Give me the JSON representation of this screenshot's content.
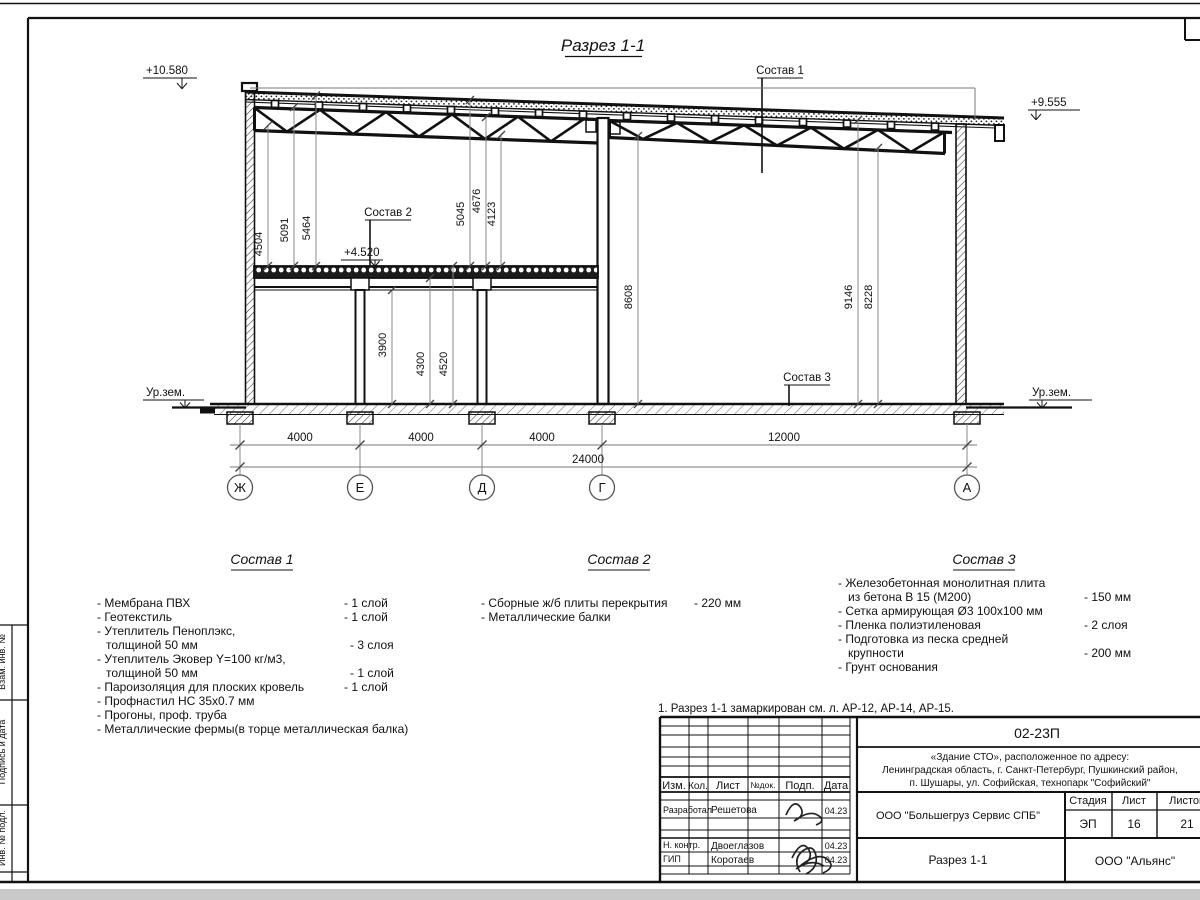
{
  "title": "Разрез 1-1",
  "note": "1. Разрез 1-1 замаркирован см. л. АР-12, АР-14, АР-15.",
  "elevations": {
    "roof_left": "+10.580",
    "roof_right": "+9.555",
    "mezzanine": "+4.520",
    "ground_left": "Ур.зем.",
    "ground_right": "Ур.зем."
  },
  "callouts": {
    "c1": "Состав 1",
    "c2": "Состав 2",
    "c3": "Состав 3"
  },
  "axes": [
    "Ж",
    "Е",
    "Д",
    "Г",
    "А"
  ],
  "dims": {
    "bottom": [
      "4000",
      "4000",
      "4000",
      "12000"
    ],
    "total": "24000",
    "left_stack": [
      "4504",
      "5091",
      "5464"
    ],
    "mid_stack": [
      "5045",
      "4676",
      "4123"
    ],
    "right_stack": [
      "8608",
      "9146",
      "8228"
    ],
    "mezz_stack": [
      "3900",
      "4300",
      "4520"
    ]
  },
  "sostav1": {
    "title": "Состав 1",
    "rows": [
      {
        "t": "- Мембрана ПВХ",
        "v": "- 1 слой"
      },
      {
        "t": "- Геотекстиль",
        "v": "- 1 слой"
      },
      {
        "t": "- Утеплитель Пеноплэкс,",
        "v": ""
      },
      {
        "t": "толщиной 50 мм",
        "v": "- 3 слоя"
      },
      {
        "t": "- Утеплитель Эковер Y=100 кг/м3,",
        "v": ""
      },
      {
        "t": "толщиной 50 мм",
        "v": "- 1 слой"
      },
      {
        "t": "- Пароизоляция для плоских кровель",
        "v": "- 1 слой"
      },
      {
        "t": "- Профнастил НС 35х0.7 мм",
        "v": ""
      },
      {
        "t": "- Прогоны, проф. труба",
        "v": ""
      },
      {
        "t": "- Металлические фермы(в торце металлическая балка)",
        "v": ""
      }
    ]
  },
  "sostav2": {
    "title": "Состав 2",
    "rows": [
      {
        "t": "- Сборные ж/б плиты перекрытия",
        "v": "- 220 мм"
      },
      {
        "t": "- Металлические балки",
        "v": ""
      }
    ]
  },
  "sostav3": {
    "title": "Состав 3",
    "rows": [
      {
        "t": "- Железобетонная  монолитная плита",
        "v": ""
      },
      {
        "t": "из бетона В 15 (М200)",
        "v": "- 150 мм"
      },
      {
        "t": "- Сетка армирующая Ø3 100х100 мм",
        "v": ""
      },
      {
        "t": "- Пленка полиэтиленовая",
        "v": "-  2 слоя"
      },
      {
        "t": "- Подготовка из песка средней",
        "v": ""
      },
      {
        "t": "крупности",
        "v": "- 200 мм"
      },
      {
        "t": "- Грунт основания",
        "v": ""
      }
    ]
  },
  "sidebar": {
    "labels": [
      "Взам. инв. №",
      "Подпись и дата",
      "Инв. № подл."
    ]
  },
  "stamp": {
    "code": "02-23П",
    "object_line1": "«Здание СТО», расположенное по адресу:",
    "object_line2": "Ленинградская область, г. Санкт-Петербург, Пушкинский район,",
    "object_line3": "п. Шушары, ул. Софийская, технопарк \"Софийский\"",
    "cols": [
      "Изм.",
      "Кол.",
      "Лист",
      "№док.",
      "Подп.",
      "Дата"
    ],
    "rows": [
      {
        "role": "Разработал",
        "name": "Решетова",
        "date": "04.23"
      },
      {
        "role": "Н. контр.",
        "name": "Двоеглазов",
        "date": "04.23"
      },
      {
        "role": "ГИП",
        "name": "Коротаев",
        "date": "04.23"
      }
    ],
    "org": "ООО \"Большегруз Сервис СПБ\"",
    "doc_title": "Разрез 1-1",
    "company": "ООО \"Альянс\"",
    "stage_label": "Стадия",
    "sheet_label": "Лист",
    "sheets_label": "Листов",
    "stage": "ЭП",
    "sheet": "16",
    "sheets": "21"
  }
}
